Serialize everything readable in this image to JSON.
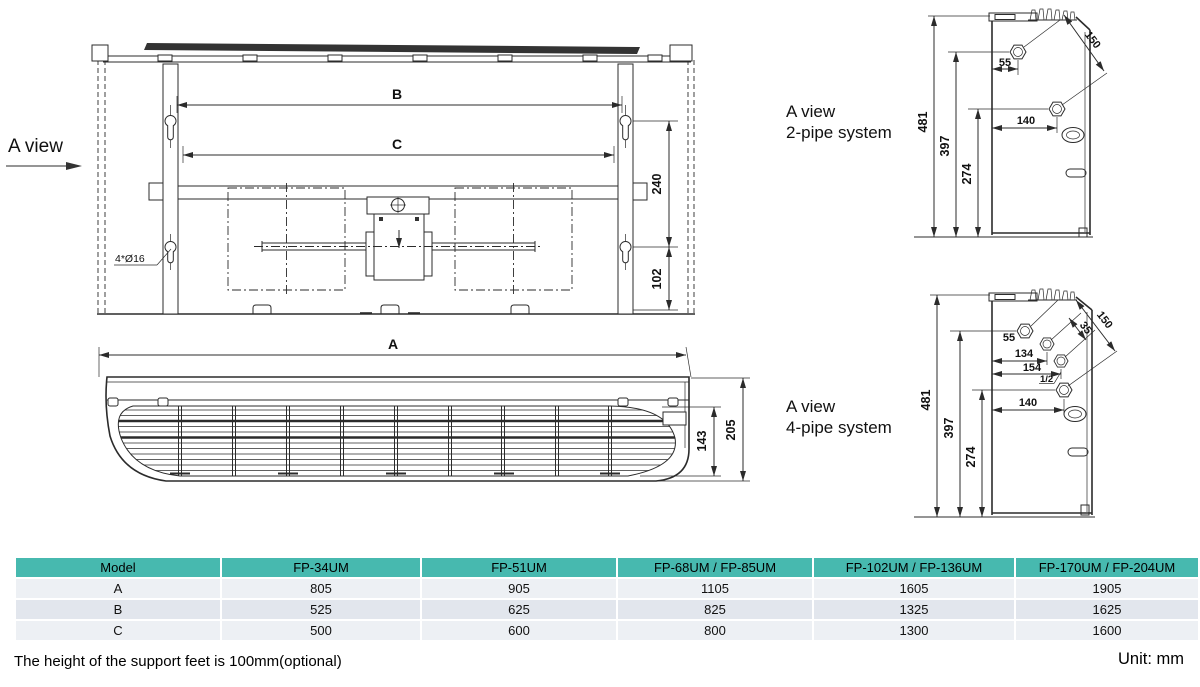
{
  "diagram": {
    "view_arrow_label": "A view",
    "rear": {
      "dim_width_b": "B",
      "dim_width_c": "C",
      "dim_height_240": "240",
      "dim_height_102": "102",
      "holes_label": "4*Ø16"
    },
    "front": {
      "dim_width_a": "A",
      "dim_height_205": "205",
      "dim_height_143": "143"
    },
    "pipe2": {
      "title1": "A view",
      "title2": "2-pipe system",
      "dim_481": "481",
      "dim_397": "397",
      "dim_274": "274",
      "dim_55": "55",
      "dim_150": "150",
      "dim_140": "140"
    },
    "pipe4": {
      "title1": "A view",
      "title2": "4-pipe system",
      "dim_481": "481",
      "dim_397": "397",
      "dim_274": "274",
      "dim_55": "55",
      "dim_134": "134",
      "dim_154": "154",
      "dim_half": "1/2",
      "dim_35": "35",
      "dim_150": "150",
      "dim_140": "140"
    }
  },
  "table": {
    "headers": [
      "Model",
      "FP-34UM",
      "FP-51UM",
      "FP-68UM / FP-85UM",
      "FP-102UM / FP-136UM",
      "FP-170UM / FP-204UM"
    ],
    "rows": [
      {
        "label": "A",
        "values": [
          "805",
          "905",
          "1105",
          "1605",
          "1905"
        ]
      },
      {
        "label": "B",
        "values": [
          "525",
          "625",
          "825",
          "1325",
          "1625"
        ]
      },
      {
        "label": "C",
        "values": [
          "500",
          "600",
          "800",
          "1300",
          "1600"
        ]
      }
    ]
  },
  "footer": {
    "note": "The height of the support feet is 100mm(optional)",
    "unit": "Unit: mm"
  },
  "colors": {
    "table_header_bg": "#47b9af",
    "row_light": "#edf0f4",
    "row_mid": "#e2e6ed",
    "line_ink": "#2b2b2b"
  }
}
